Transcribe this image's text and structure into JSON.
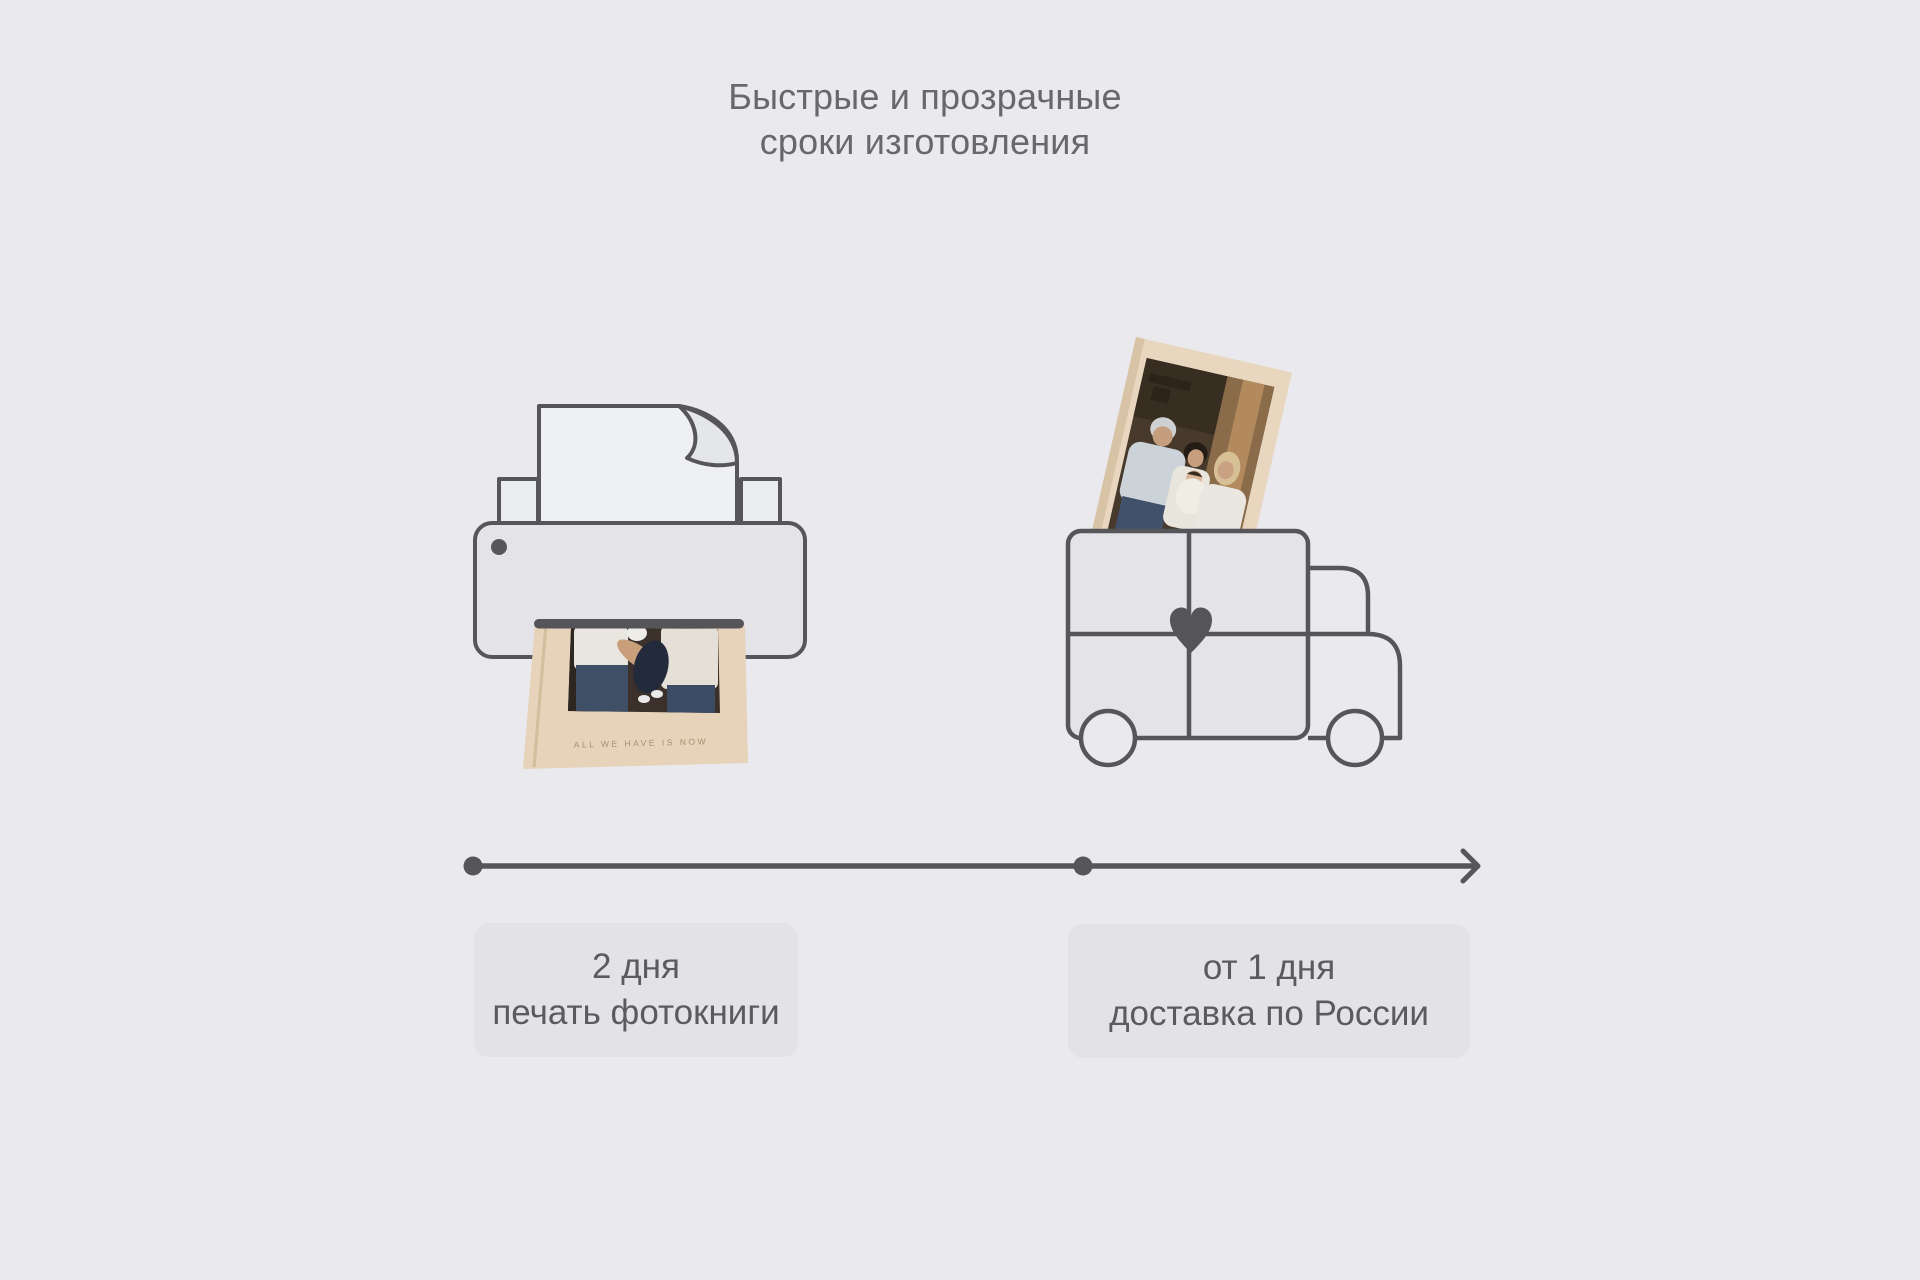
{
  "page": {
    "background_color": "#e9e9ee"
  },
  "title": {
    "line1": "Быстрые и прозрачные",
    "line2": "сроки изготовления",
    "text_color": "#67676c"
  },
  "illustrations": {
    "printer": {
      "description": "outline printer printing a photobook",
      "outline_color": "#56565a",
      "body_fill": "#e3e3e8",
      "paper_fill": "#eff0f3"
    },
    "photobook": {
      "caption": "ALL WE HAVE IS NOW",
      "cover_color": "#e7d3ba",
      "caption_color": "#a3906f"
    },
    "truck": {
      "description": "outline delivery truck with heart, photobook sticking out of cargo box",
      "outline_color": "#56565a",
      "cargo_fill": "#e3e3e8",
      "heart_color": "#545459"
    }
  },
  "timeline": {
    "color": "#55555a",
    "dots": 2
  },
  "steps": [
    {
      "duration": "2 дня",
      "label": "печать фотокниги"
    },
    {
      "duration": "от 1 дня",
      "label": "доставка по России"
    }
  ],
  "cards": {
    "fill": "#e2e2e7",
    "text_color": "#5a5a5f"
  }
}
